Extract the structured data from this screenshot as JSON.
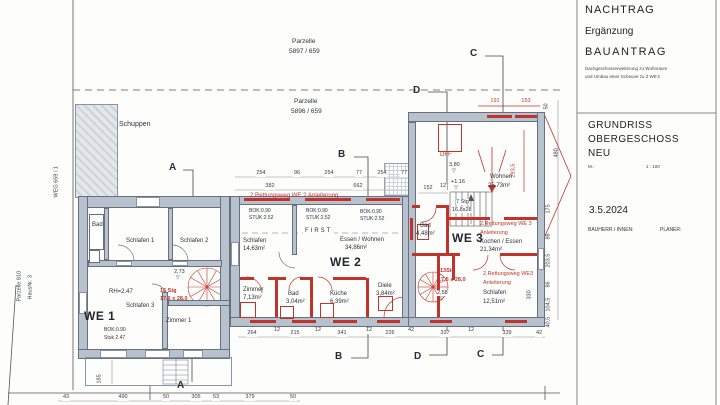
{
  "colors": {
    "accent_red": "#bf352c",
    "wall_fill": "#b8c2ce"
  },
  "symbols": {
    "level_mark": "▽"
  },
  "sections": {
    "a": "A",
    "b": "B",
    "c": "C",
    "d": "D"
  },
  "site": {
    "weg": "WEG 659 / 1",
    "parzelle_left_line1": "Parzelle 810",
    "parzelle_left_line2": "HausNr. 3",
    "parzelle_top_line1": "Parzelle",
    "parzelle_top_line2": "5897 / 659",
    "parzelle_mid_line1": "Parzelle",
    "parzelle_mid_line2": "5896 / 659",
    "schuppen": "Schuppen"
  },
  "title_block": {
    "line1": "NACHTRAG",
    "line2": "Ergänzung",
    "line3": "BAUANTRAG",
    "sub1": "Dachgeschosserweiterung zu Wohnraum",
    "sub2": "und Umbau einer Scheune zu 2 WE's",
    "title1": "GRUNDRISS",
    "title2": "OBERGESCHOSS",
    "title3": "NEU",
    "scale_label": "M.:",
    "scale_value": "1 : 100",
    "date": "3.5.2024",
    "bauherr": "BAUHERR / INNEN:",
    "planer": "PLANER:"
  },
  "we1": {
    "name": "WE 1",
    "bad": "Bad",
    "schlafen1": "Schlafen 1",
    "schlafen2": "Schlafen 2",
    "schlafen3": "Schlafen 3",
    "zimmer1": "Zimmer 1",
    "rh": "RH=2.47",
    "bok": "BOK:0.90",
    "stuk": "Stuk 2.47",
    "level": "2,73",
    "stair_line1": "16 Stg",
    "stair_line2": "17,6 x 28,0"
  },
  "we2": {
    "name": "WE 2",
    "rescue": "2.Rettungsweg WE 2.Anleiterung",
    "bok": "BOK:0.90",
    "stuk": "STUK:2.52",
    "first": "FIRST",
    "schlafen": "Schlafen",
    "schlafen_area": "14,63m²",
    "essen": "Essen / Wohnen",
    "essen_area": "34,86m²",
    "zimmer": "Zimmer",
    "zimmer_area": "7,13m²",
    "bad": "Bad",
    "bad_area": "3,04m²",
    "kueche": "Küche",
    "kueche_area": "6,39m²",
    "diele": "Diele",
    "diele_area": "3,84m²"
  },
  "we3": {
    "name": "WE 3",
    "dff": "DFF",
    "wohnen": "Wohnen",
    "wohnen_area": "25,73m²",
    "level_top": "3,80",
    "level_entry": "+1.16",
    "level_low": "2,58",
    "stair_line1": "7 Stg",
    "stair_line2": "16,8x28",
    "spiral_line1": "13Stg",
    "spiral_line2": "17,5 x 28,0",
    "bad": "Bad",
    "bad_area": "4,48m²",
    "kochen": "Kochen / Essen",
    "kochen_area": "21,34m²",
    "schlafen": "Schlafen",
    "schlafen_area": "12,51m²",
    "rescue1_line1": "2.Rettungsweg WE 3",
    "rescue1_line2": "Anleiterung",
    "rescue2_line1": "2.Rettungsweg WE3",
    "rescue2_line2": "Anleiterung"
  },
  "dims": {
    "top_chain": [
      "254",
      "96",
      "254",
      "77",
      "254",
      "77"
    ],
    "mid_chain": [
      "382",
      "662"
    ],
    "bottom_left": [
      "43",
      "490",
      "50",
      "305",
      "53",
      "379",
      "50"
    ],
    "bottom_mid": [
      "264",
      "12",
      "215",
      "12",
      "341",
      "12",
      "226",
      "42",
      "337",
      "12",
      "339",
      "42"
    ],
    "right_chain": [
      "50",
      "480",
      "175",
      "86",
      "203,5",
      "86",
      "104,5",
      "40,5"
    ],
    "right_inner": "330",
    "we3_top": [
      "191",
      "153"
    ],
    "we3_inner": [
      "152",
      "12"
    ],
    "ridge": "293,5",
    "porch": "185"
  }
}
